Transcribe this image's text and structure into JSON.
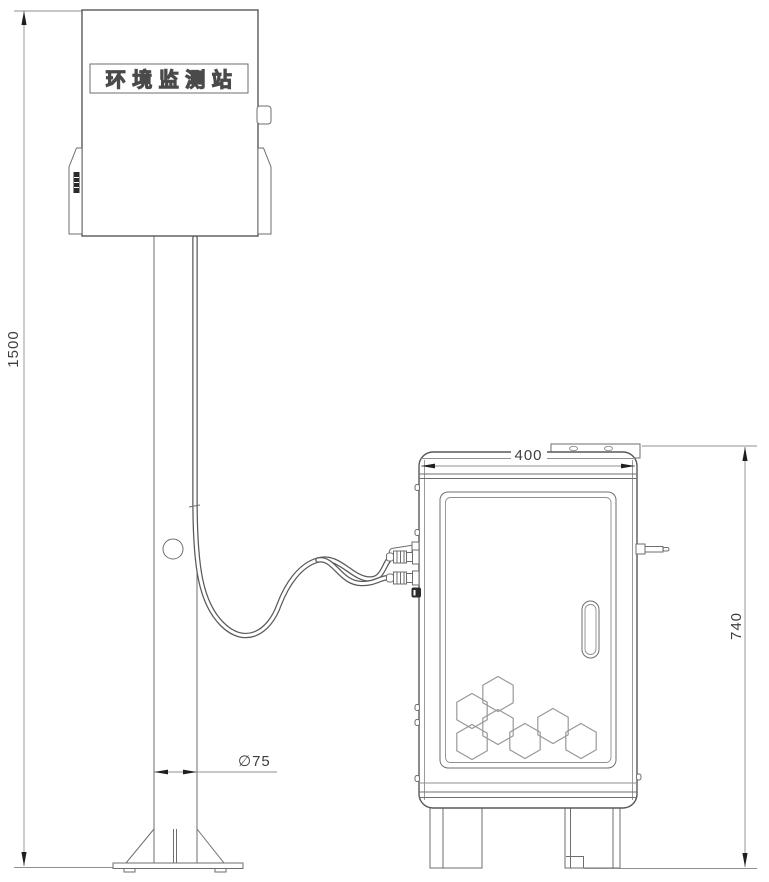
{
  "station": {
    "label": "环境监测站"
  },
  "dimensions": {
    "pole_height": "1500",
    "pole_diameter": "∅75",
    "cabinet_width": "400",
    "cabinet_height": "740"
  },
  "colors": {
    "background": "#ffffff",
    "outline": "#585858",
    "secondary_line": "#6e6e6e",
    "thin_dimension_line": "#8f8f8f",
    "hexagon_line": "#9a9a9a",
    "arrow": "#1f1f1f",
    "dimension_text": "#3f3f3f",
    "label_fill": "#ffffff",
    "label_outline": "#4a4a4a"
  }
}
